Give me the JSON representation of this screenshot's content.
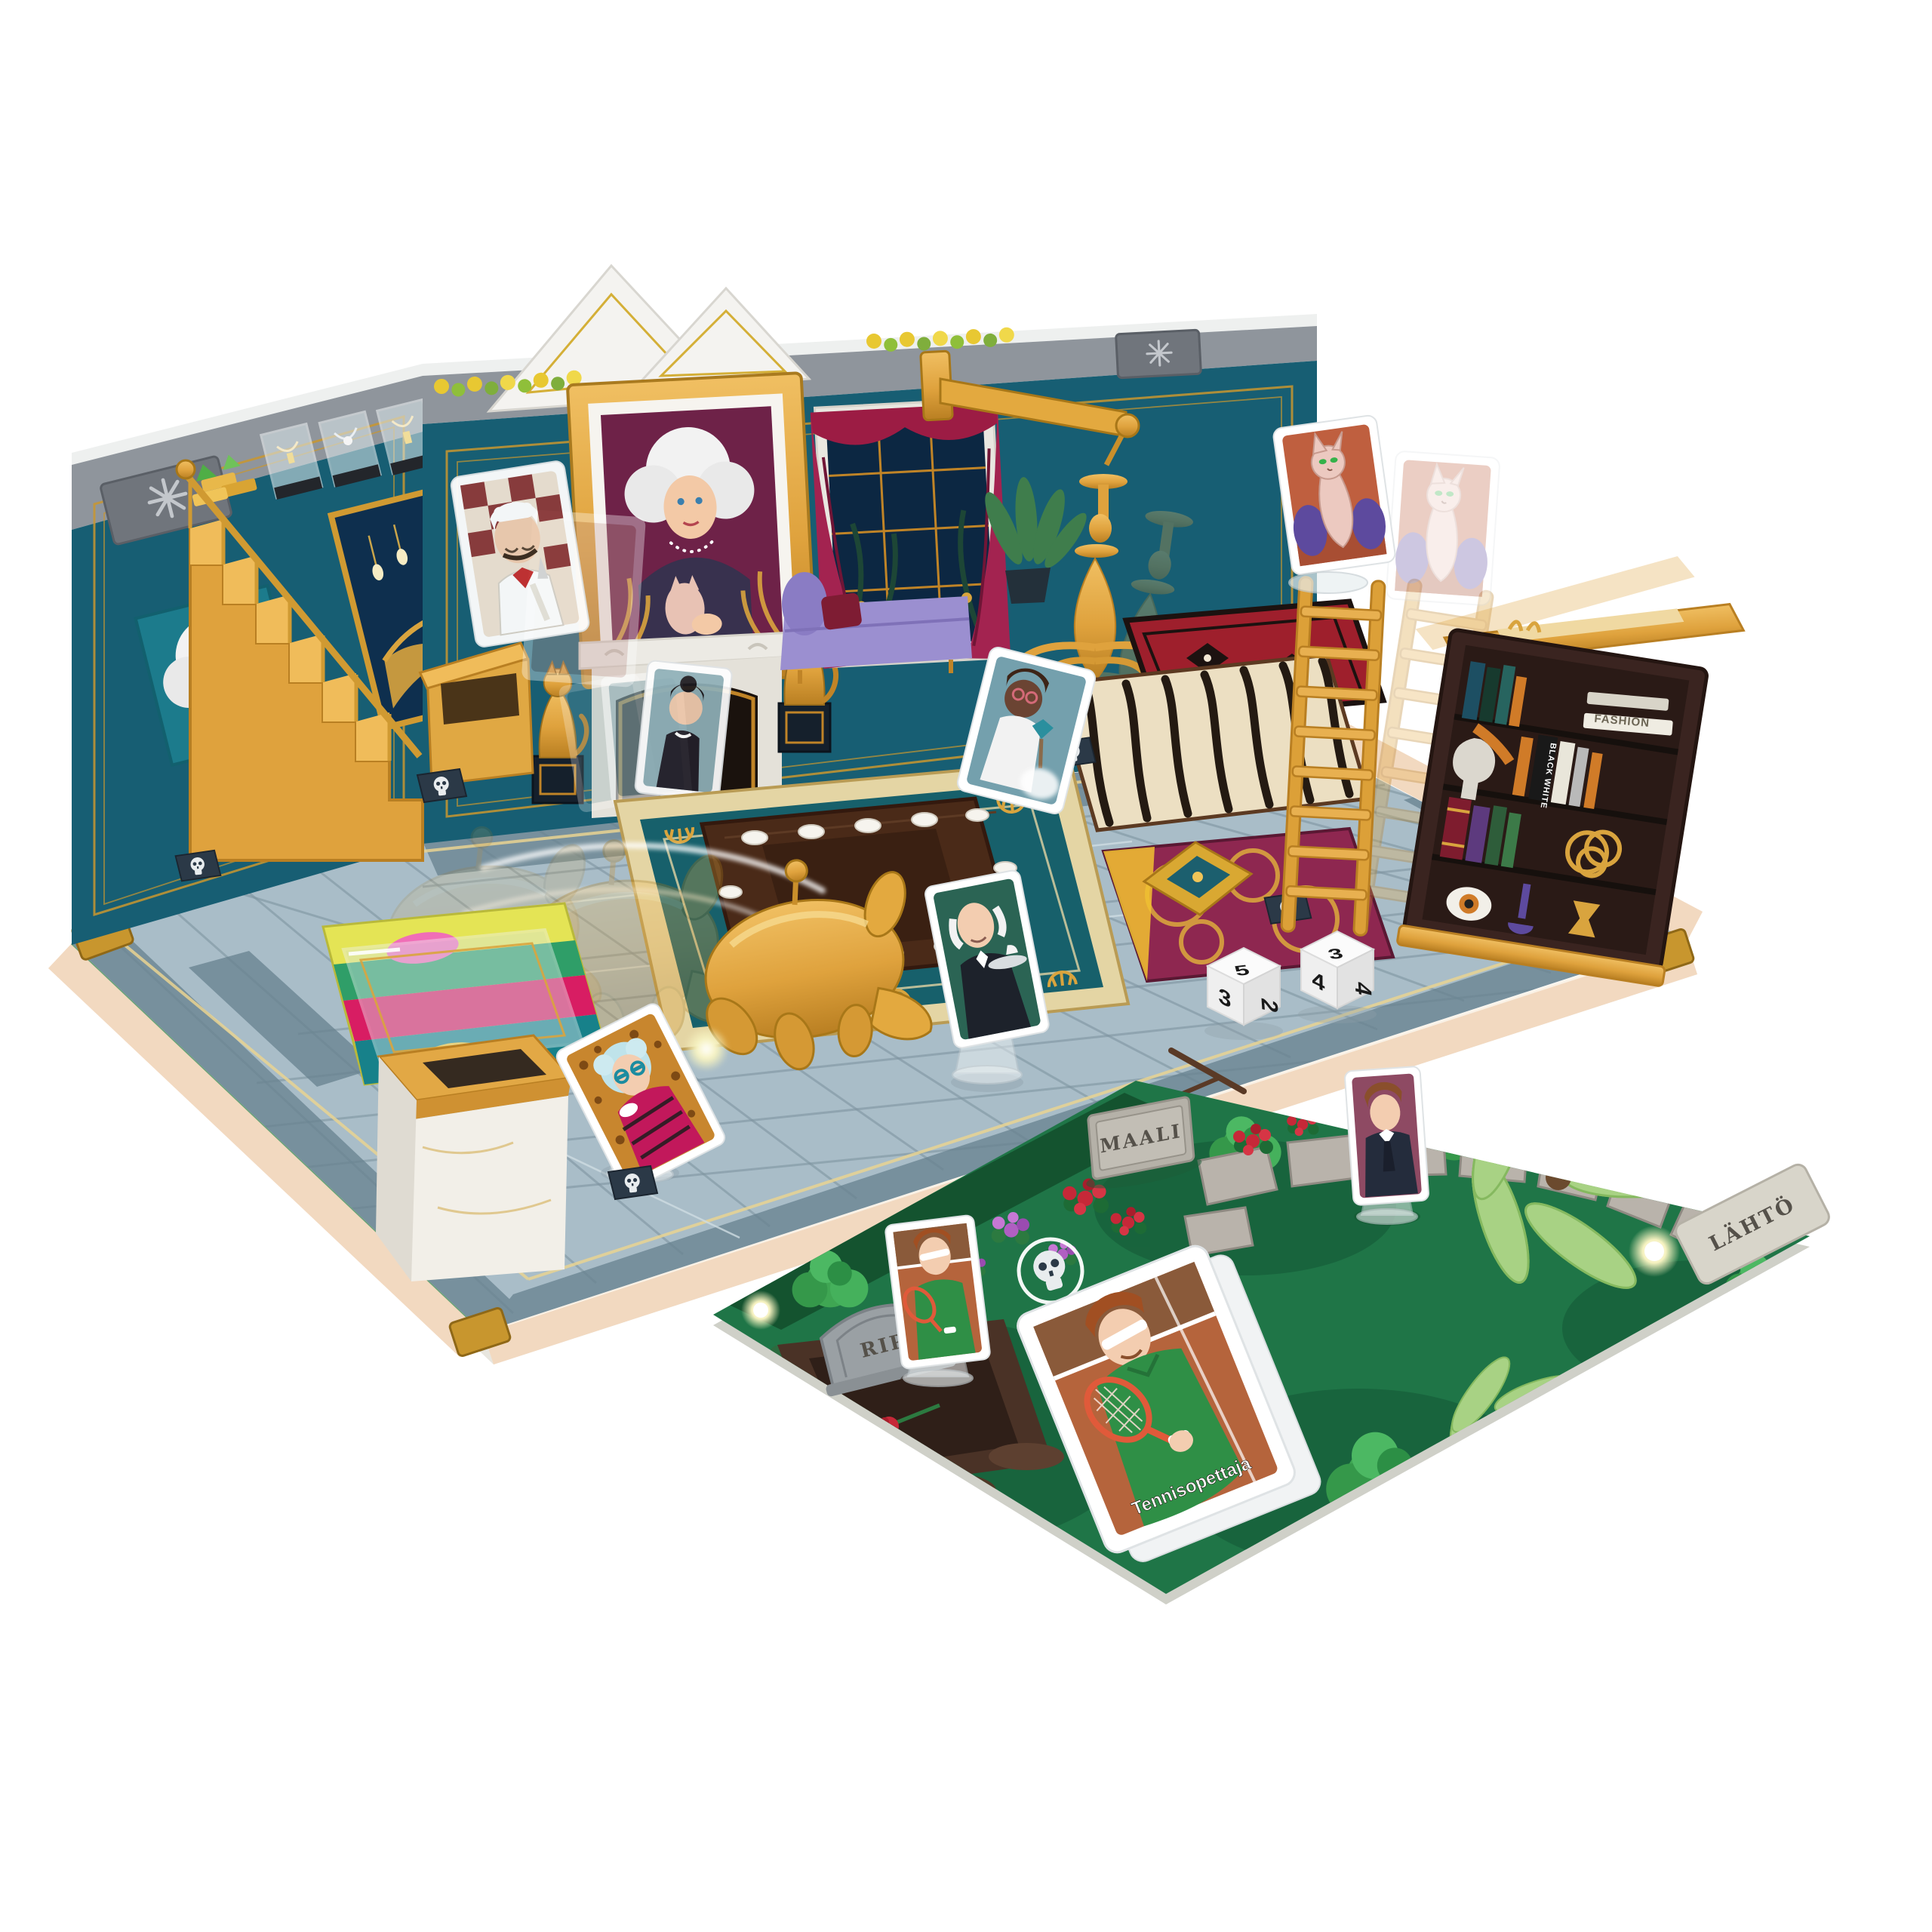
{
  "scene": {
    "description": "Pop-up 3D murder-mystery board game: mansion room with falling chandelier, ladder and bookcase, flying character cards, dice, and a garden extension board with grave",
    "background": "#ffffff"
  },
  "signs": {
    "finish": "MAALI",
    "start": "LÄHTÖ",
    "gravestone": "RIP",
    "big_card_label": "Tennisopettaja"
  },
  "bookshelf": {
    "book_spine_fashion": "FASHION",
    "book_spine_black_white": "BLACK WHITE"
  },
  "dice": {
    "die1": {
      "top": "5",
      "left": "3",
      "right": "2"
    },
    "die2": {
      "top": "3",
      "left": "4",
      "right": "4"
    }
  },
  "colors": {
    "wall": "#175e73",
    "wall_deep": "#11485a",
    "gold": "#dfa23d",
    "gold_dark": "#b97f22",
    "metal_band": "#8f959c",
    "floor": "#a9bdc8",
    "floor_tile_dark": "#67828f",
    "board_border": "#f2d9c0",
    "garden": "#1f7547",
    "garden_bush": "#3fa653",
    "curtain": "#9c1c44",
    "rug_red": "#9e1f2c",
    "rug_maroon": "#8e2750",
    "rug_zebra": "#ecdfc2",
    "rug_deco_teal": "#17606b",
    "marble": "#f2efe8",
    "clay": "#b5643c",
    "tennis_green": "#2f8f46",
    "skull_tile": "#2b3947",
    "die_face": "#fbfbfb"
  }
}
